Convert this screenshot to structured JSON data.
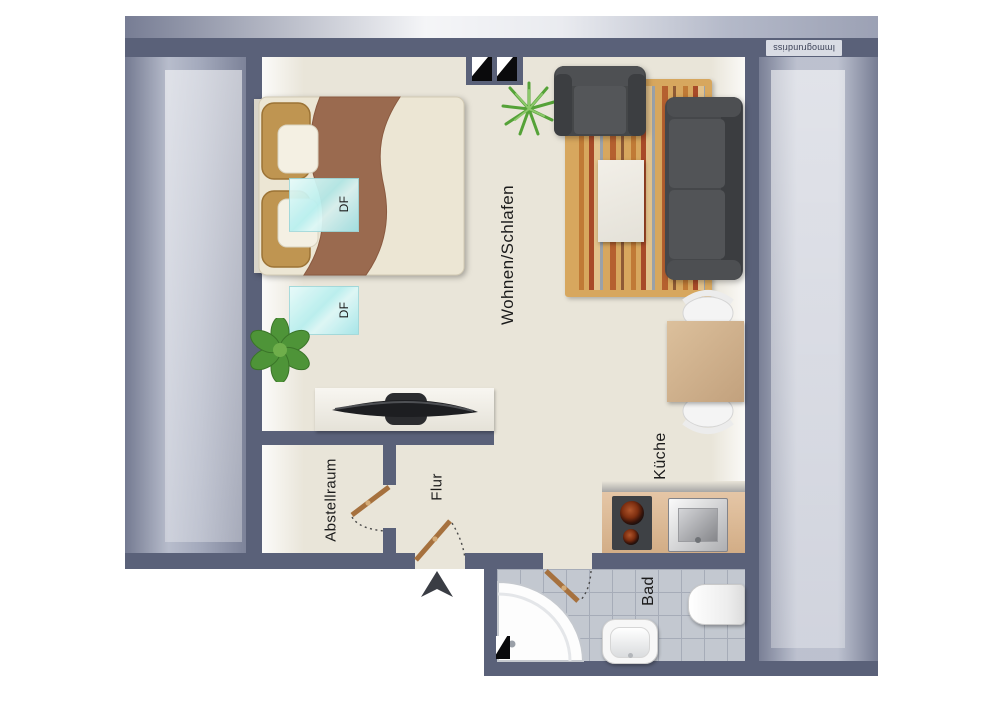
{
  "watermark": {
    "text": "Immogrundriss"
  },
  "rooms": {
    "living": {
      "label": "Wohnen/Schlafen"
    },
    "kitchen": {
      "label": "Küche"
    },
    "hall": {
      "label": "Flur"
    },
    "storage": {
      "label": "Abstellraum"
    },
    "bath": {
      "label": "Bad"
    }
  },
  "skylights": {
    "first": "DF",
    "second": "DF"
  },
  "colors": {
    "wall": "#5a6179",
    "floor": "#e9e5d9",
    "roof_stripe_dark": "#9da3b6",
    "roof_stripe_light": "#c6cad6",
    "skylight": "#b7efef",
    "door_leaf": "#a6713e",
    "bath_tile": "#c3c8d0",
    "kitchen_counter": "#dcb897",
    "rug_base": "#d7a75e",
    "sofa_gray": "#47494c",
    "burner_red": "#7e2f10"
  }
}
